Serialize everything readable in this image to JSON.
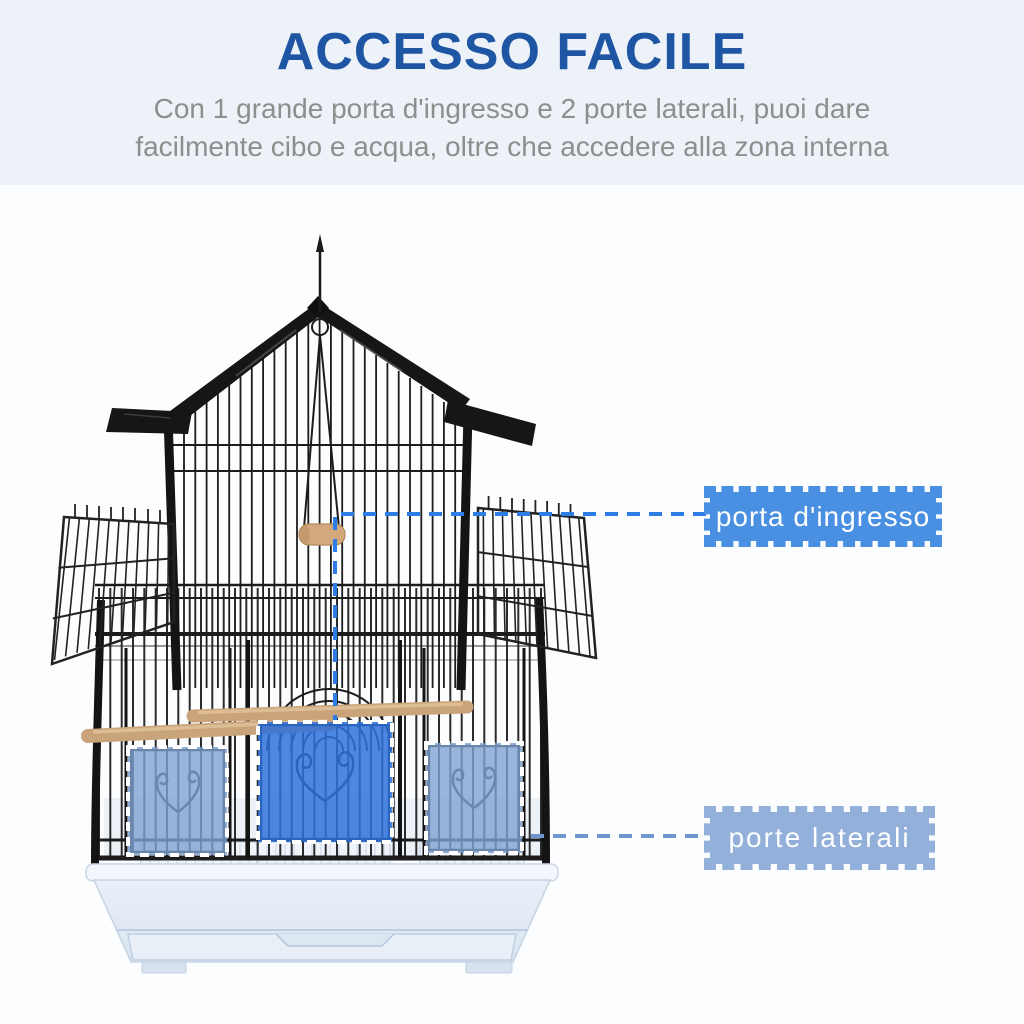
{
  "page": {
    "background": "#fcfdfe",
    "hero_background": "#edf1f8"
  },
  "hero": {
    "title": "ACCESSO FACILE",
    "title_color": "#1e56a4",
    "subtitle_line1": "Con 1 grande porta d'ingresso e 2 porte laterali, puoi dare",
    "subtitle_line2": "facilmente cibo e acqua, oltre che accedere alla zona interna",
    "subtitle_color": "#8e8e8e"
  },
  "callouts": [
    {
      "id": "entry-door",
      "label": "porta d'ingresso",
      "box_color": "#4a90e2",
      "line_color": "#2d7de6",
      "text_color": "#ffffff"
    },
    {
      "id": "side-doors",
      "label": "porte laterali",
      "box_color": "#92b0da",
      "line_color": "#6f96d1",
      "text_color": "#ffffff"
    }
  ],
  "illustration": {
    "description": "black wire bird cage with house roof, swing, wooden perches, white tray",
    "cage_color": "#1c1c1c",
    "entry_door_overlay": "#2f72dc",
    "side_door_overlay": "#7fa3d2",
    "door_border_color": "#ffffff",
    "perch_color": "#c9a47a",
    "tray_color": "#e9eff7"
  }
}
